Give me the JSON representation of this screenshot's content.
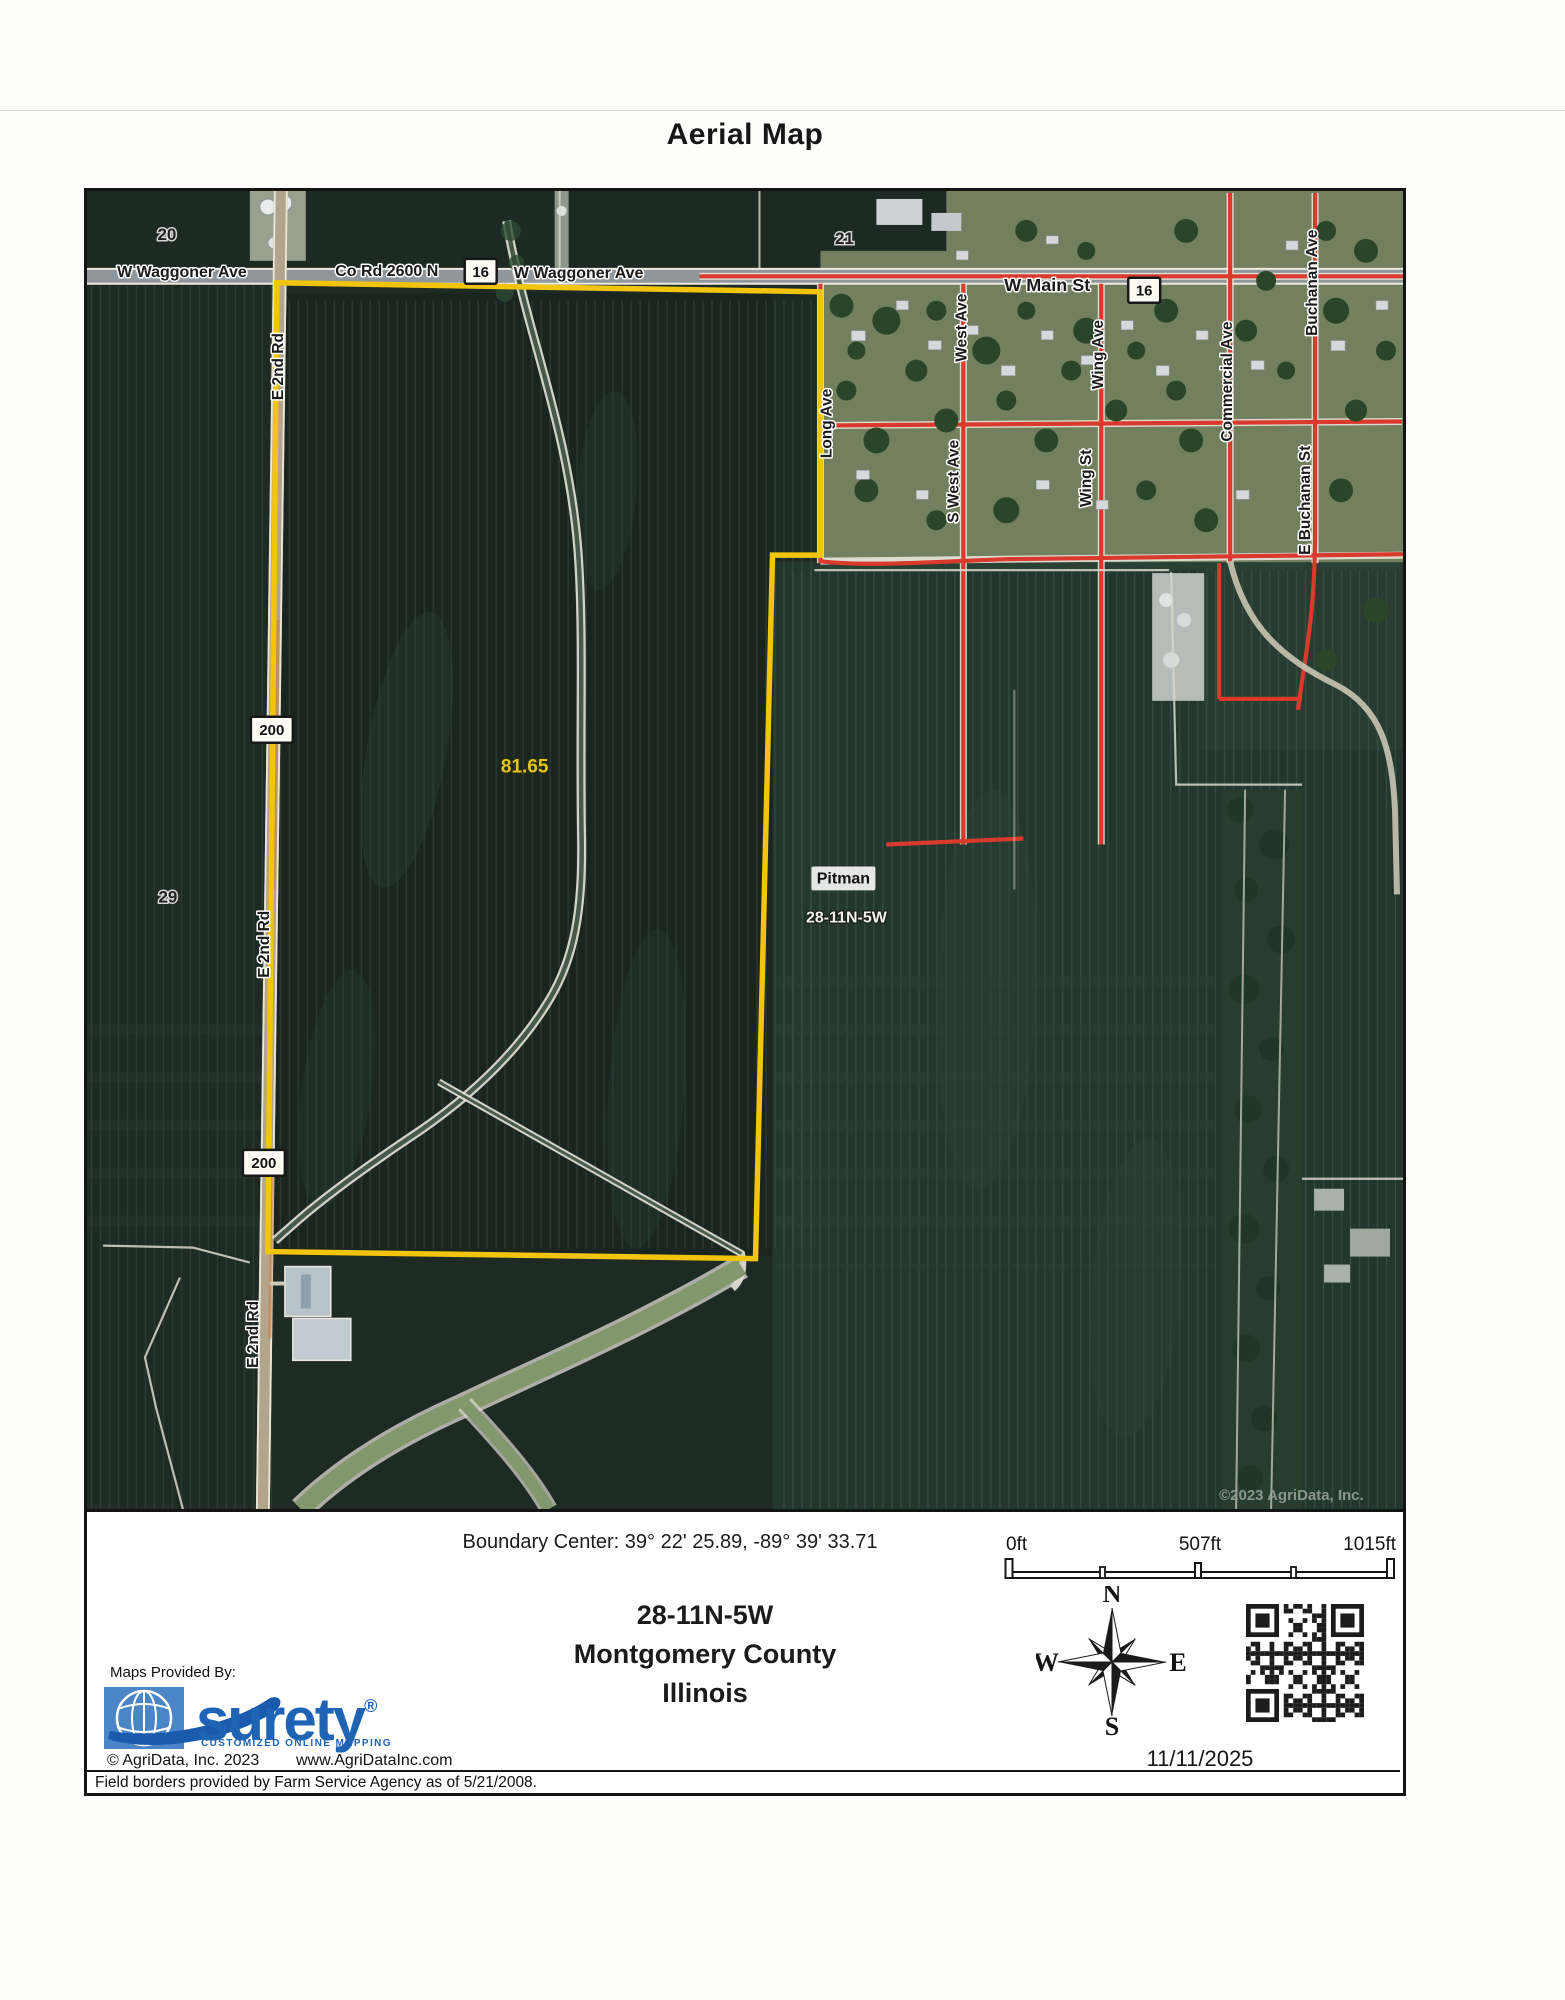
{
  "header": {
    "title": "Aerial Map"
  },
  "map": {
    "labels": {
      "waggoner_w": "W Waggoner Ave",
      "co_rd": "Co Rd 2600 N",
      "waggoner_e": "W Waggoner Ave",
      "main_st": "W Main St",
      "shield16": "16",
      "shield200": "200",
      "sec20": "20",
      "sec21": "21",
      "sec29": "29",
      "e2nd_rd": "E 2nd Rd",
      "long_ave": "Long Ave",
      "west_ave": "West Ave",
      "s_west_ave": "S West Ave",
      "wing_ave": "Wing Ave",
      "wing_st": "Wing St",
      "commercial_ave": "Commercial Ave",
      "buchanan_ave": "Buchanan Ave",
      "e_buchanan_st": "E Buchanan St",
      "acreage": "81.65",
      "pitman": "Pitman",
      "plss": "28-11N-5W",
      "watermark": "©2023 AgriData, Inc."
    }
  },
  "footer": {
    "boundary_center": "Boundary Center: 39° 22' 25.89, -89° 39' 33.71",
    "scale": {
      "start": "0ft",
      "mid": "507ft",
      "end": "1015ft"
    },
    "plss": "28-11N-5W",
    "county": "Montgomery County",
    "state": "Illinois",
    "compass": {
      "n": "N",
      "e": "E",
      "s": "S",
      "w": "W"
    },
    "date": "11/11/2025",
    "maps_provided_by": "Maps Provided By:",
    "brand": "surety",
    "brand_reg": "®",
    "brand_tagline": "CUSTOMIZED ONLINE MAPPING",
    "copyright": "© AgriData, Inc. 2023",
    "website": "www.AgriDataInc.com",
    "field_borders_note": "Field borders provided by Farm Service Agency as of 5/21/2008."
  },
  "colors": {
    "boundary_yellow": "#F2C50A",
    "road_red": "#D93A2C",
    "brand_blue": "#1E63B4",
    "field_dark_green": "#1D2A24",
    "town_green": "#72805F"
  }
}
